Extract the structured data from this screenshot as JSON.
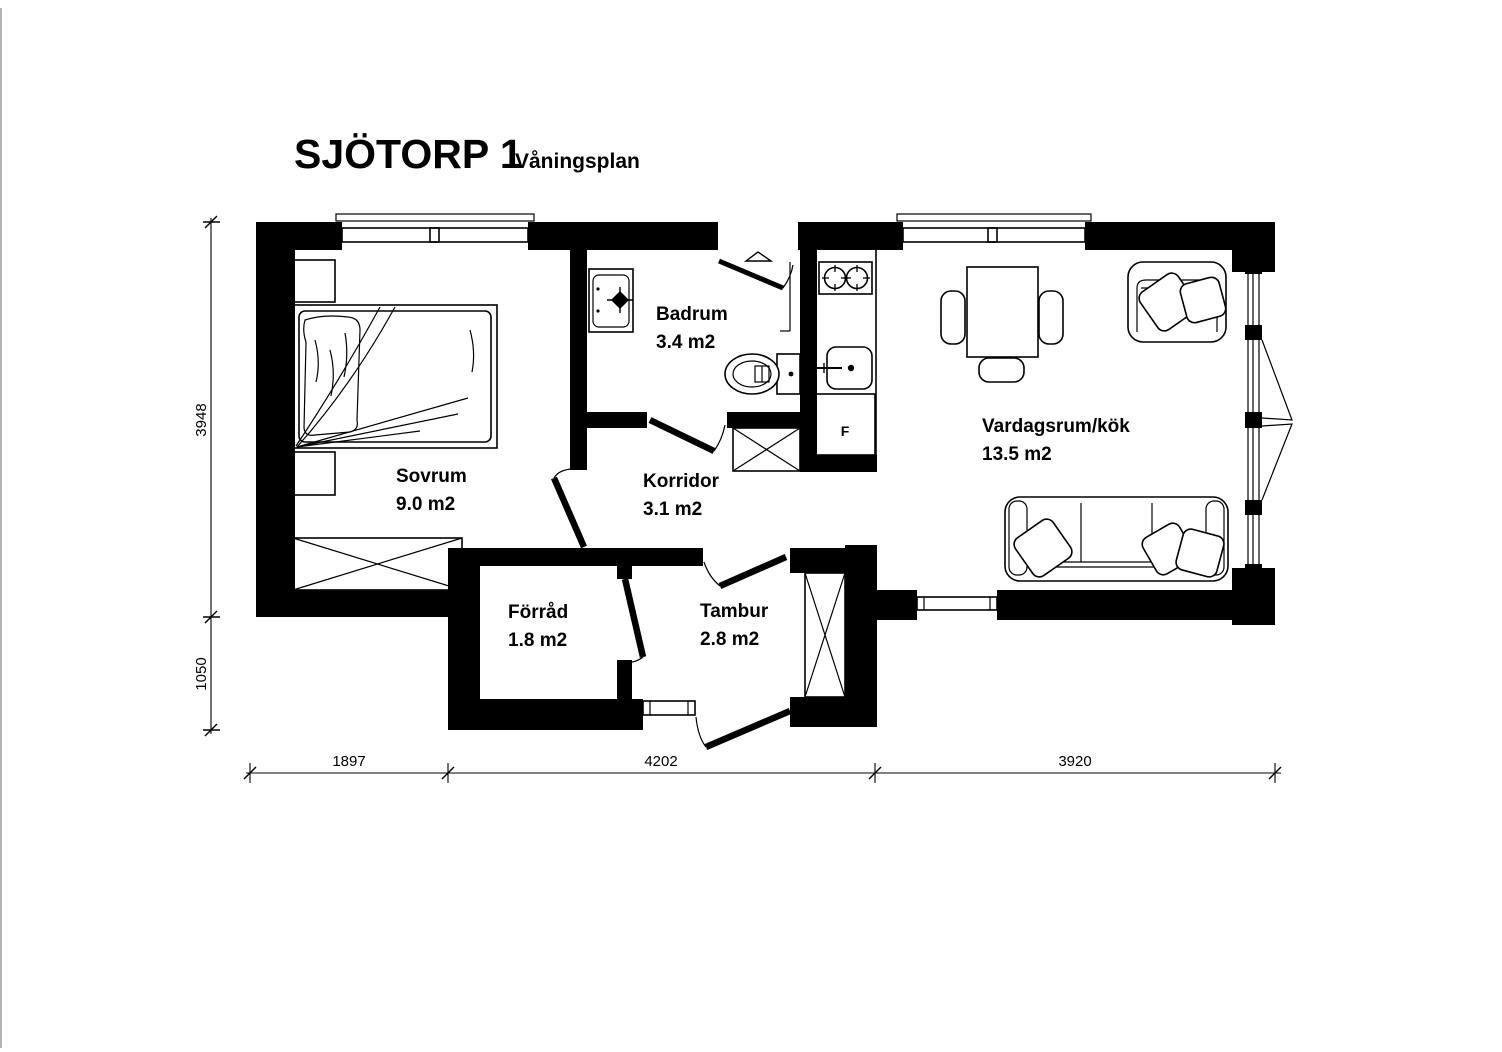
{
  "title": {
    "main": "SJÖTORP 1",
    "subtitle": "Våningsplan"
  },
  "rooms": [
    {
      "id": "sovrum",
      "name": "Sovrum",
      "area": "9.0 m2"
    },
    {
      "id": "badrum",
      "name": "Badrum",
      "area": "3.4 m2"
    },
    {
      "id": "korridor",
      "name": "Korridor",
      "area": "3.1 m2"
    },
    {
      "id": "forrad",
      "name": "Förråd",
      "area": "1.8 m2"
    },
    {
      "id": "tambur",
      "name": "Tambur",
      "area": "2.8 m2"
    },
    {
      "id": "vardagsrum",
      "name": "Vardagsrum/kök",
      "area": "13.5 m2"
    }
  ],
  "appliances": {
    "fridge_label": "F"
  },
  "dimensions": {
    "vertical": [
      "3948",
      "1050"
    ],
    "horizontal": [
      "1897",
      "4202",
      "3920"
    ]
  },
  "colors": {
    "wall": "#000000",
    "background": "#ffffff",
    "line": "#000000"
  }
}
